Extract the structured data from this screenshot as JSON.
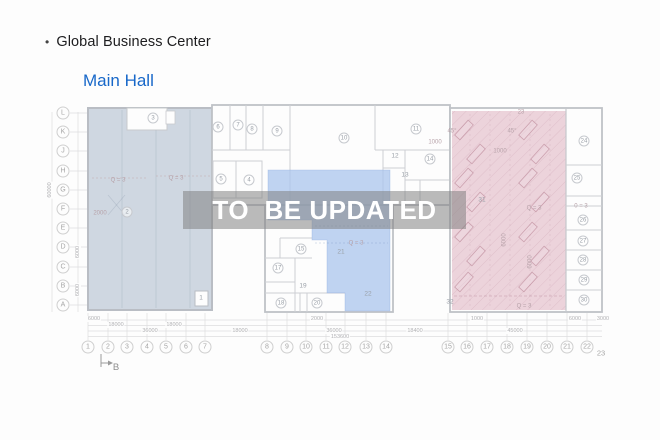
{
  "header": {
    "bullet": "•",
    "title": "Global Business Center",
    "subtitle": "Main Hall"
  },
  "watermark": {
    "text": "TO  BE UPDATED"
  },
  "colors": {
    "subtitle": "#1868c9",
    "left_zone": "#cfd7e1",
    "mid_zone": "rgba(170,196,236,0.75)",
    "right_zone": "#ecd3db",
    "wall": "#bfc2c7",
    "watermark_bg": "rgba(127,127,127,0.53)",
    "watermark_text": "#ffffff"
  },
  "plan": {
    "rows": [
      {
        "l": "L",
        "y": 113
      },
      {
        "l": "K",
        "y": 132
      },
      {
        "l": "J",
        "y": 151
      },
      {
        "l": "H",
        "y": 171
      },
      {
        "l": "G",
        "y": 190
      },
      {
        "l": "F",
        "y": 209
      },
      {
        "l": "E",
        "y": 228
      },
      {
        "l": "D",
        "y": 247
      },
      {
        "l": "C",
        "y": 267
      },
      {
        "l": "B",
        "y": 286
      },
      {
        "l": "A",
        "y": 305
      }
    ],
    "cols": [
      {
        "l": "1",
        "x": 88
      },
      {
        "l": "2",
        "x": 108
      },
      {
        "l": "3",
        "x": 127
      },
      {
        "l": "4",
        "x": 147
      },
      {
        "l": "5",
        "x": 166
      },
      {
        "l": "6",
        "x": 186
      },
      {
        "l": "7",
        "x": 205
      },
      {
        "l": "8",
        "x": 267
      },
      {
        "l": "9",
        "x": 287
      },
      {
        "l": "10",
        "x": 306
      },
      {
        "l": "11",
        "x": 326
      },
      {
        "l": "12",
        "x": 345
      },
      {
        "l": "13",
        "x": 366
      },
      {
        "l": "14",
        "x": 386
      },
      {
        "l": "15",
        "x": 448
      },
      {
        "l": "16",
        "x": 467
      },
      {
        "l": "17",
        "x": 487
      },
      {
        "l": "18",
        "x": 507
      },
      {
        "l": "19",
        "x": 527
      },
      {
        "l": "20",
        "x": 547
      },
      {
        "l": "21",
        "x": 567
      },
      {
        "l": "22",
        "x": 587
      },
      {
        "l": "23",
        "x": 601,
        "y": 353,
        "p": true
      }
    ],
    "rooms": [
      {
        "l": "1",
        "x": 201,
        "y": 298,
        "p": true
      },
      {
        "l": "2",
        "x": 127,
        "y": 212
      },
      {
        "l": "3",
        "x": 153,
        "y": 118
      },
      {
        "l": "4",
        "x": 249,
        "y": 180
      },
      {
        "l": "5",
        "x": 221,
        "y": 179
      },
      {
        "l": "6",
        "x": 218,
        "y": 127
      },
      {
        "l": "7",
        "x": 238,
        "y": 125
      },
      {
        "l": "8",
        "x": 252,
        "y": 129
      },
      {
        "l": "9",
        "x": 277,
        "y": 131
      },
      {
        "l": "10",
        "x": 344,
        "y": 138
      },
      {
        "l": "11",
        "x": 416,
        "y": 129
      },
      {
        "l": "12",
        "x": 395,
        "y": 156,
        "p": true
      },
      {
        "l": "13",
        "x": 405,
        "y": 175,
        "p": true
      },
      {
        "l": "14",
        "x": 430,
        "y": 159
      },
      {
        "l": "15",
        "x": 301,
        "y": 249
      },
      {
        "l": "17",
        "x": 278,
        "y": 268
      },
      {
        "l": "18",
        "x": 281,
        "y": 303
      },
      {
        "l": "19",
        "x": 303,
        "y": 286,
        "p": true
      },
      {
        "l": "20",
        "x": 317,
        "y": 303
      },
      {
        "l": "21",
        "x": 341,
        "y": 252,
        "p": true
      },
      {
        "l": "22",
        "x": 368,
        "y": 294,
        "p": true
      },
      {
        "l": "24",
        "x": 584,
        "y": 141
      },
      {
        "l": "25",
        "x": 577,
        "y": 178
      },
      {
        "l": "26",
        "x": 583,
        "y": 220
      },
      {
        "l": "27",
        "x": 583,
        "y": 241
      },
      {
        "l": "28",
        "x": 583,
        "y": 260
      },
      {
        "l": "29",
        "x": 584,
        "y": 280
      },
      {
        "l": "30",
        "x": 584,
        "y": 300
      },
      {
        "l": "31",
        "x": 482,
        "y": 200,
        "p": true
      },
      {
        "l": "32",
        "x": 450,
        "y": 302,
        "p": true
      }
    ],
    "dims": [
      {
        "t": "6000",
        "x": 94,
        "y": 319
      },
      {
        "t": "18000",
        "x": 116,
        "y": 324.5
      },
      {
        "t": "18000",
        "x": 174,
        "y": 324.5
      },
      {
        "t": "36000",
        "x": 150,
        "y": 330.5
      },
      {
        "t": "18000",
        "x": 240,
        "y": 330.5
      },
      {
        "t": "2000",
        "x": 317,
        "y": 319
      },
      {
        "t": "1000",
        "x": 477,
        "y": 319
      },
      {
        "t": "6000",
        "x": 575,
        "y": 319
      },
      {
        "t": "3000",
        "x": 603,
        "y": 319
      },
      {
        "t": "18400",
        "x": 415,
        "y": 330.5
      },
      {
        "t": "45000",
        "x": 515,
        "y": 330.5
      },
      {
        "t": "36000",
        "x": 334,
        "y": 330.5
      },
      {
        "t": "153600",
        "x": 340,
        "y": 336.5
      }
    ],
    "side_dims": [
      {
        "t": "60000",
        "x": 50,
        "y": 190
      },
      {
        "t": "6000",
        "x": 78,
        "y": 252
      },
      {
        "t": "6000",
        "x": 78,
        "y": 290
      }
    ],
    "notes": [
      {
        "t": "Q = 3",
        "x": 118,
        "y": 181
      },
      {
        "t": "Q = 3",
        "x": 176,
        "y": 179
      },
      {
        "t": "2000",
        "x": 100,
        "y": 214
      },
      {
        "t": "Q = 3",
        "x": 356,
        "y": 244
      },
      {
        "t": "Q = 3",
        "x": 534,
        "y": 209
      },
      {
        "t": "0 = 3",
        "x": 581,
        "y": 207
      },
      {
        "t": "Q = 3",
        "x": 524,
        "y": 307
      },
      {
        "t": "23",
        "x": 521,
        "y": 113
      },
      {
        "t": "45°",
        "x": 452,
        "y": 132
      },
      {
        "t": "45°",
        "x": 512,
        "y": 132
      },
      {
        "t": "1000",
        "x": 435,
        "y": 143
      },
      {
        "t": "1000",
        "x": 500,
        "y": 152
      },
      {
        "t": "6000",
        "x": 505,
        "y": 240,
        "r": -90
      },
      {
        "t": "6000",
        "x": 531,
        "y": 262,
        "r": -90
      },
      {
        "t": "B",
        "x": 116,
        "y": 368,
        "b": true
      }
    ],
    "desks": [
      [
        464,
        130
      ],
      [
        476,
        154
      ],
      [
        464,
        178
      ],
      [
        476,
        202
      ],
      [
        464,
        232
      ],
      [
        476,
        256
      ],
      [
        464,
        282
      ],
      [
        528,
        130
      ],
      [
        540,
        154
      ],
      [
        528,
        178
      ],
      [
        540,
        202
      ],
      [
        528,
        232
      ],
      [
        540,
        256
      ],
      [
        528,
        282
      ]
    ]
  }
}
